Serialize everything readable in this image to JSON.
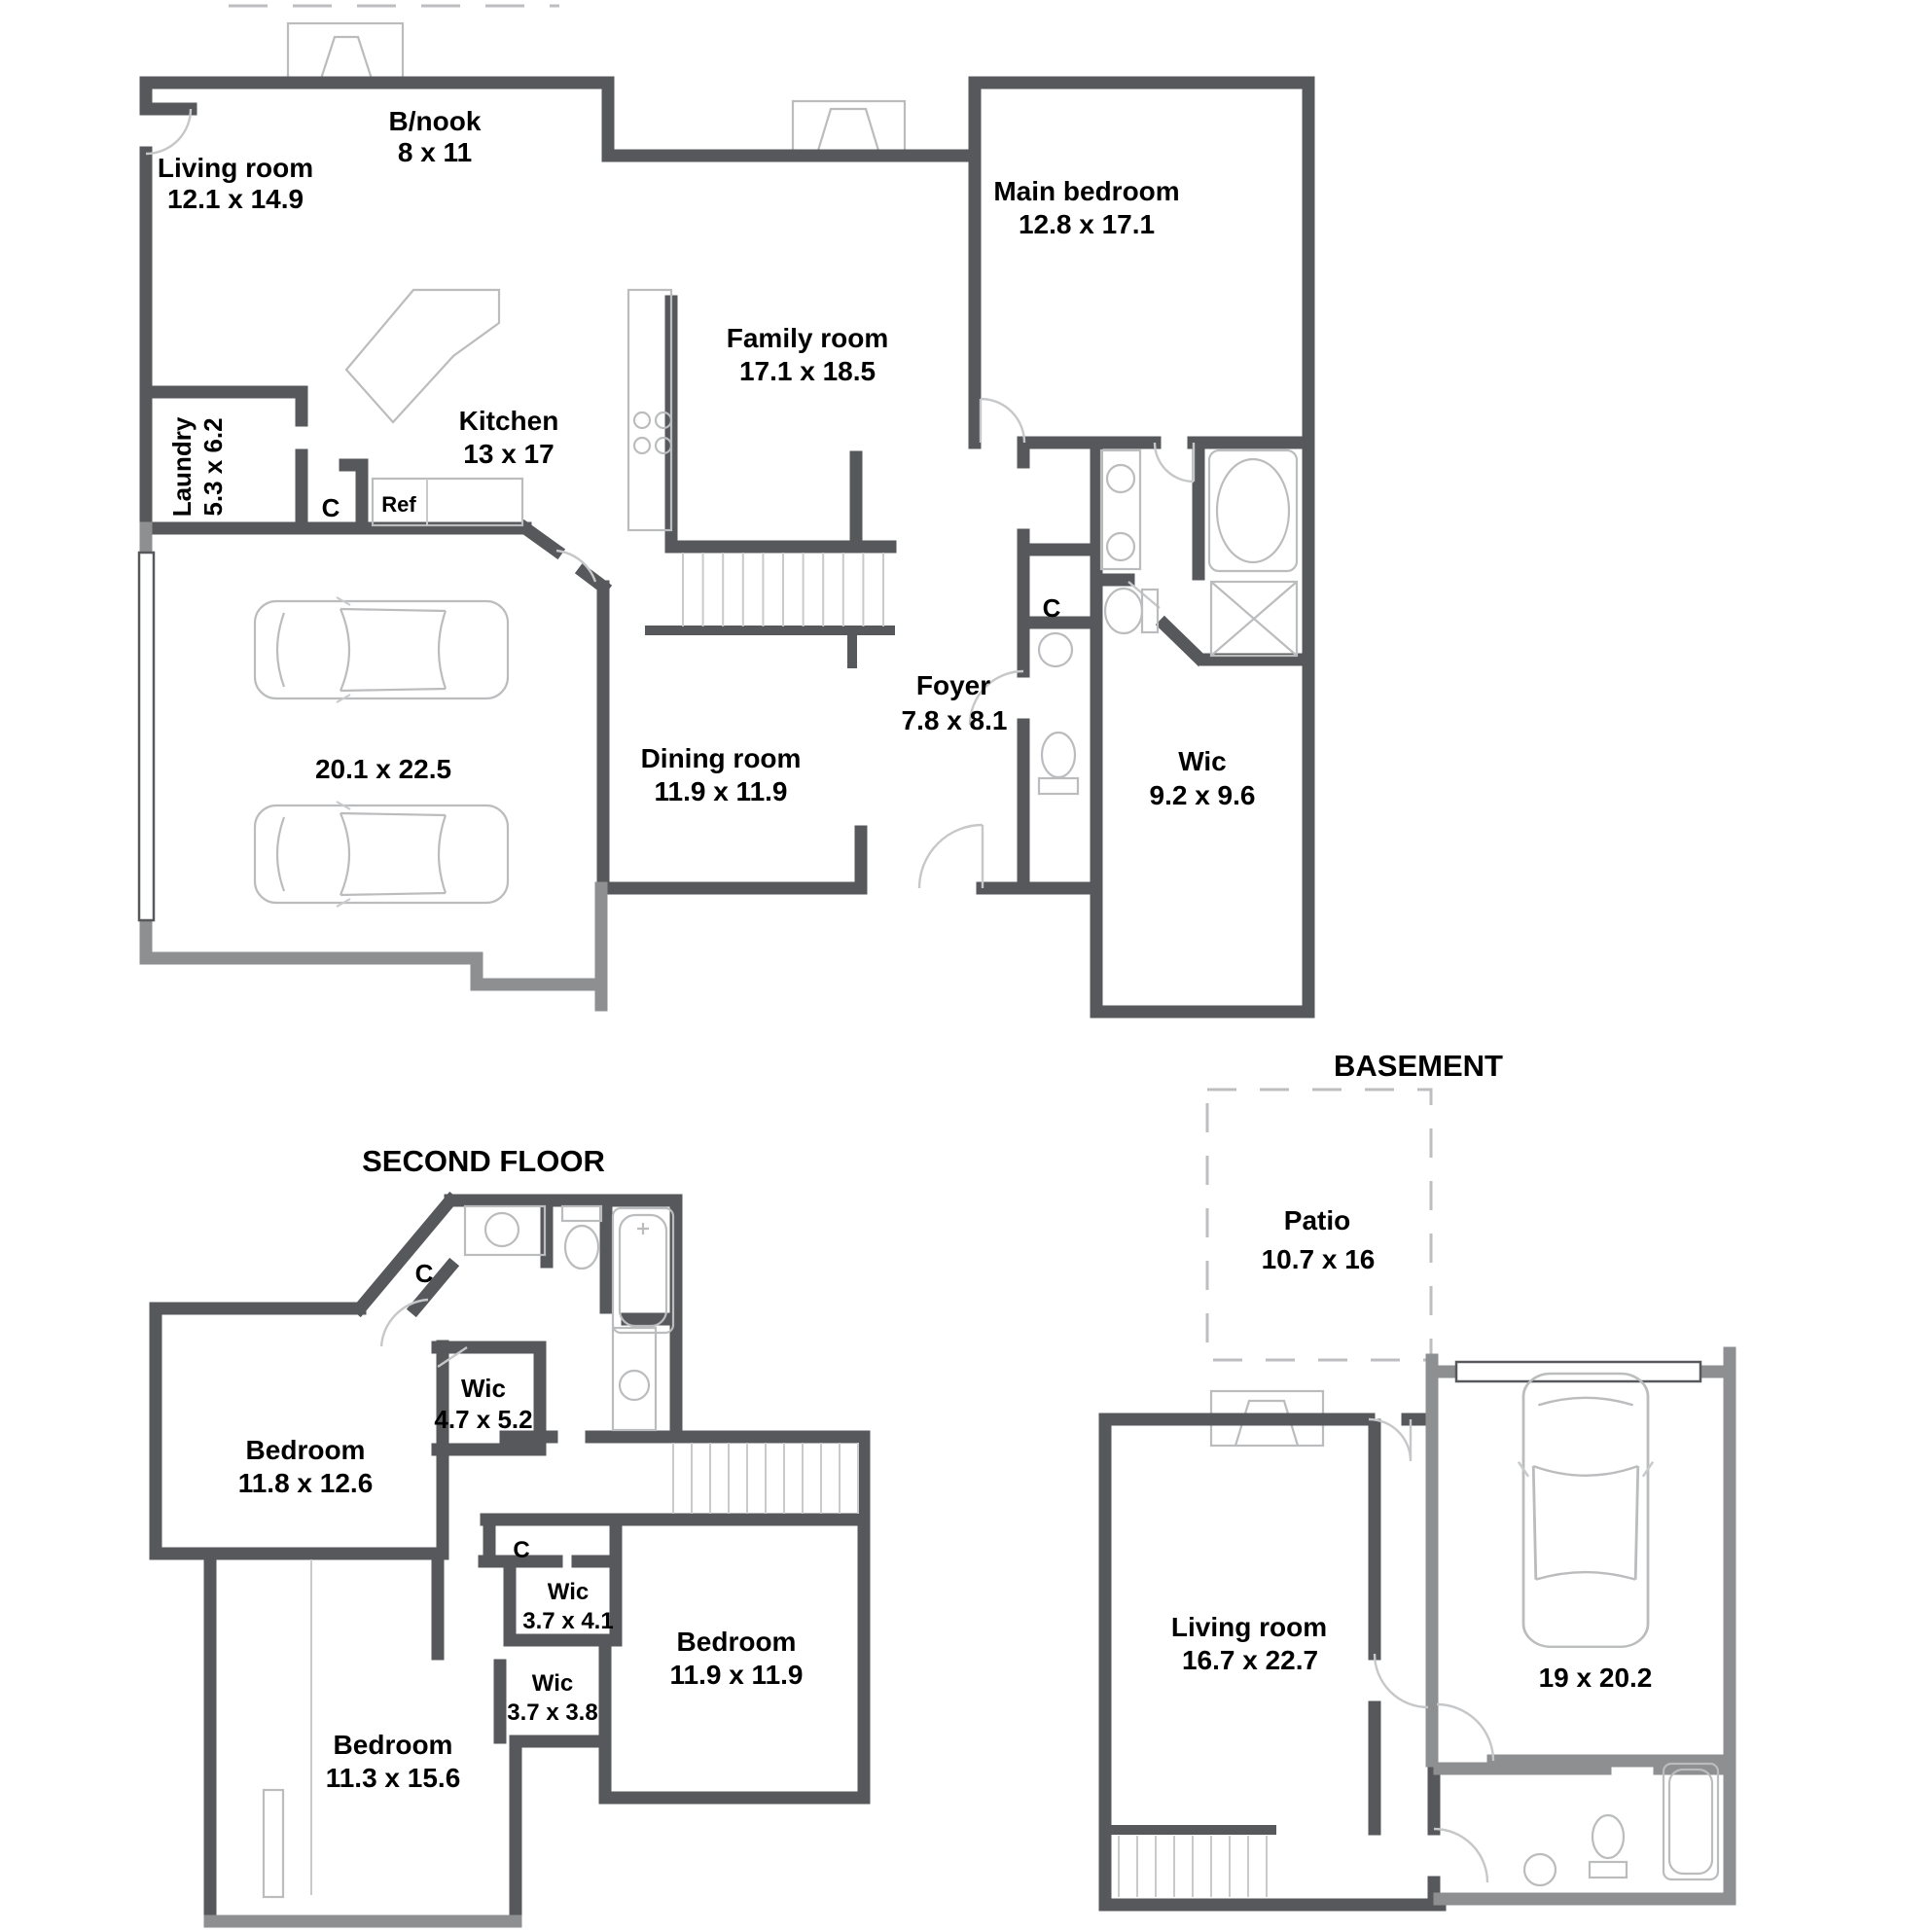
{
  "colors": {
    "wall_dark": "#57585B",
    "wall_gray": "#8E8F91",
    "fixture_gray": "#BBBCBE",
    "text": "#000000",
    "background": "#FFFFFF"
  },
  "floors": {
    "main_floor": {
      "rooms": {
        "living_room": {
          "name": "Living room",
          "dims": "12.1 x 14.9"
        },
        "breakfast_nook": {
          "name": "B/nook",
          "dims": "8 x 11"
        },
        "main_bedroom": {
          "name": "Main bedroom",
          "dims": "12.8 x 17.1"
        },
        "family_room": {
          "name": "Family room",
          "dims": "17.1 x 18.5"
        },
        "kitchen": {
          "name": "Kitchen",
          "dims": "13 x 17"
        },
        "laundry": {
          "name": "Laundry",
          "dims": "5.3 x 6.2"
        },
        "closet_kitchen": {
          "name": "C"
        },
        "fridge": {
          "name": "Ref"
        },
        "garage": {
          "dims": "20.1 x 22.5"
        },
        "dining_room": {
          "name": "Dining room",
          "dims": "11.9 x 11.9"
        },
        "foyer": {
          "name": "Foyer",
          "dims": "7.8 x 8.1"
        },
        "closet_foyer": {
          "name": "C"
        },
        "wic": {
          "name": "Wic",
          "dims": "9.2 x 9.6"
        }
      }
    },
    "second_floor": {
      "title": "SECOND FLOOR",
      "rooms": {
        "bedroom_1": {
          "name": "Bedroom",
          "dims": "11.8 x 12.6"
        },
        "closet_hall": {
          "name": "C"
        },
        "wic_1": {
          "name": "Wic",
          "dims": "4.7 x 5.2"
        },
        "closet_2": {
          "name": "C"
        },
        "wic_2": {
          "name": "Wic",
          "dims": "3.7 x 4.1"
        },
        "wic_3": {
          "name": "Wic",
          "dims": "3.7 x 3.8"
        },
        "bedroom_2": {
          "name": "Bedroom",
          "dims": "11.9 x 11.9"
        },
        "bedroom_3": {
          "name": "Bedroom",
          "dims": "11.3 x 15.6"
        }
      }
    },
    "basement": {
      "title": "BASEMENT",
      "rooms": {
        "patio": {
          "name": "Patio",
          "dims": "10.7 x 16"
        },
        "living_room": {
          "name": "Living room",
          "dims": "16.7 x 22.7"
        },
        "garage": {
          "dims": "19 x 20.2"
        }
      }
    }
  }
}
